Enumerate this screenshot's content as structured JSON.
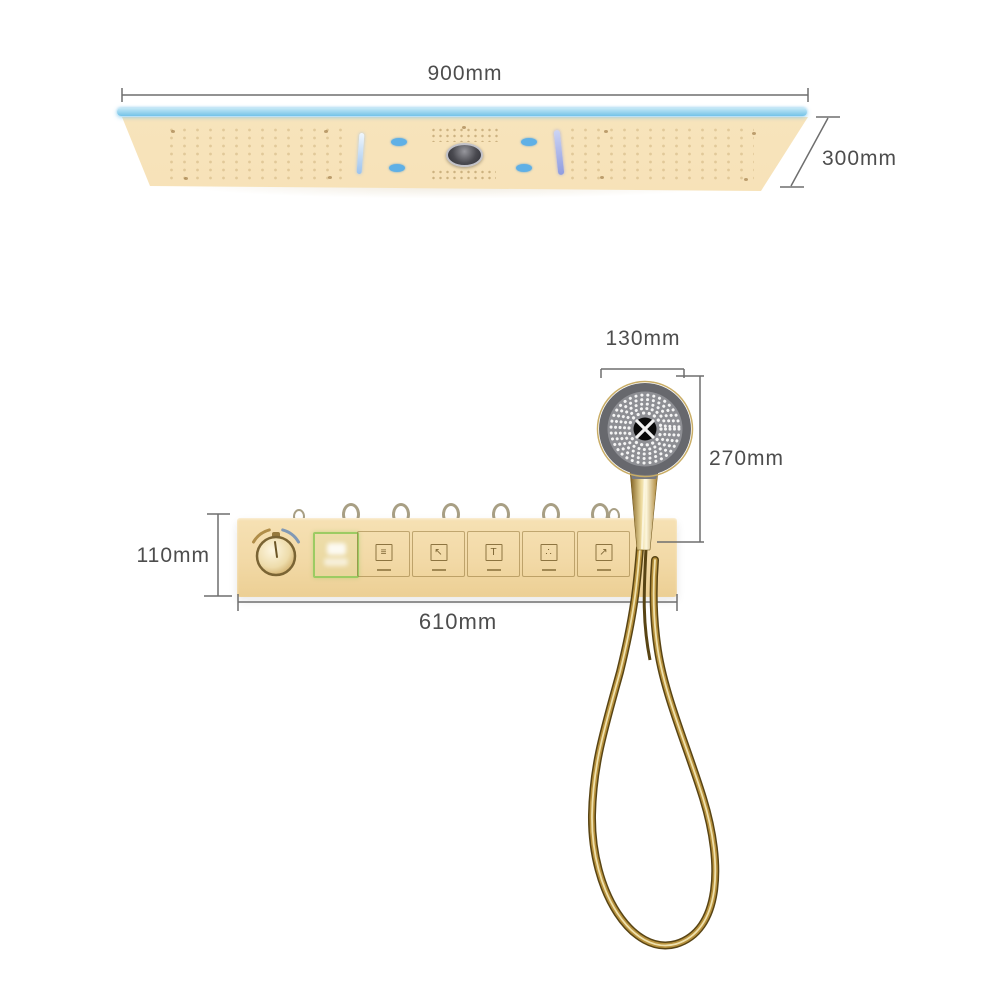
{
  "annotations": {
    "ceiling_shower_width": "900mm",
    "ceiling_shower_depth": "300mm",
    "hand_shower_width": "130mm",
    "hand_shower_height": "270mm",
    "valve_panel_height": "110mm",
    "valve_panel_width": "610mm"
  },
  "control_panel": {
    "buttons": [
      {
        "icon": "rain-shower-icon",
        "glyph": "≡"
      },
      {
        "icon": "waterfall-icon",
        "glyph": "↖"
      },
      {
        "icon": "column-spray-icon",
        "glyph": "T"
      },
      {
        "icon": "mist-spray-icon",
        "glyph": "∴"
      },
      {
        "icon": "hand-shower-icon",
        "glyph": "↗"
      }
    ]
  },
  "colors": {
    "background": "#ffffff",
    "panel_beige": "#f4ddad",
    "led_strip_blue": "#7ec7e9",
    "led_bar_purple": "#8f9ce0",
    "display_green_border": "#9ccb63",
    "gold": "#b8923d",
    "head_gray": "#8e8f94",
    "dimension_line": "#6e6e6e",
    "text": "#4d4d4d"
  }
}
